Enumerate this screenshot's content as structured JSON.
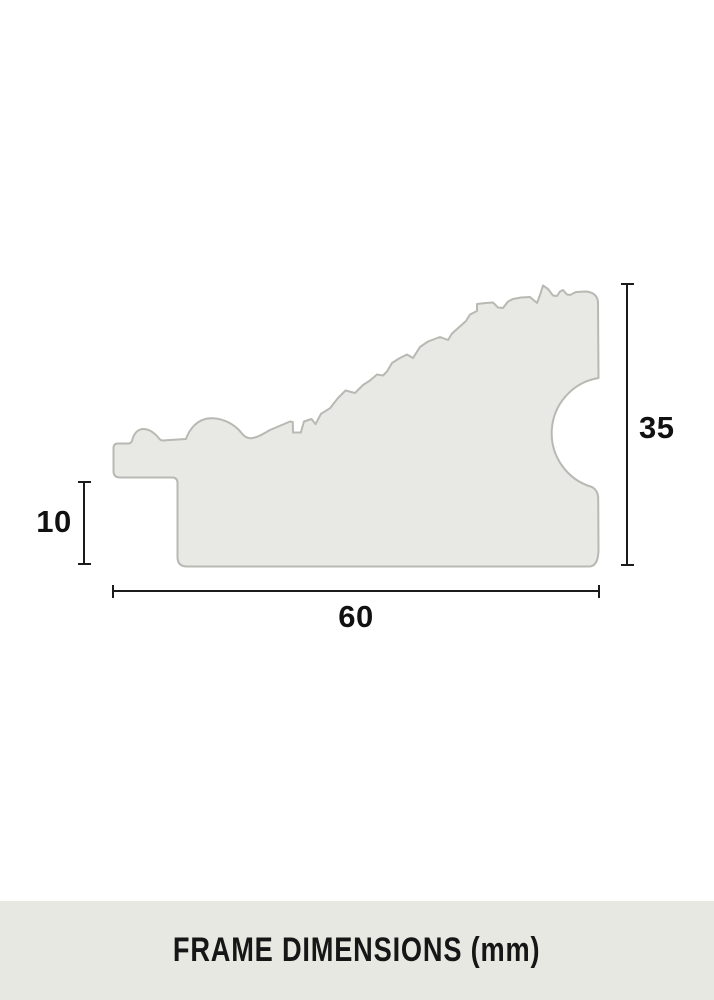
{
  "diagram": {
    "dimensions": {
      "profile_height": {
        "label": "35"
      },
      "rabbet_height": {
        "label": "10"
      },
      "profile_width": {
        "label": "60"
      }
    }
  },
  "footer": {
    "label": "FRAME DIMENSIONS (mm)"
  },
  "colors": {
    "background": "#ffffff",
    "profile_fill": "#e8e9e4",
    "profile_stroke": "#b8b9b3",
    "dimension_line": "#1b1b1b",
    "dimension_text": "#111111",
    "footer_bg": "#e8e8e3",
    "footer_text": "#161616"
  }
}
